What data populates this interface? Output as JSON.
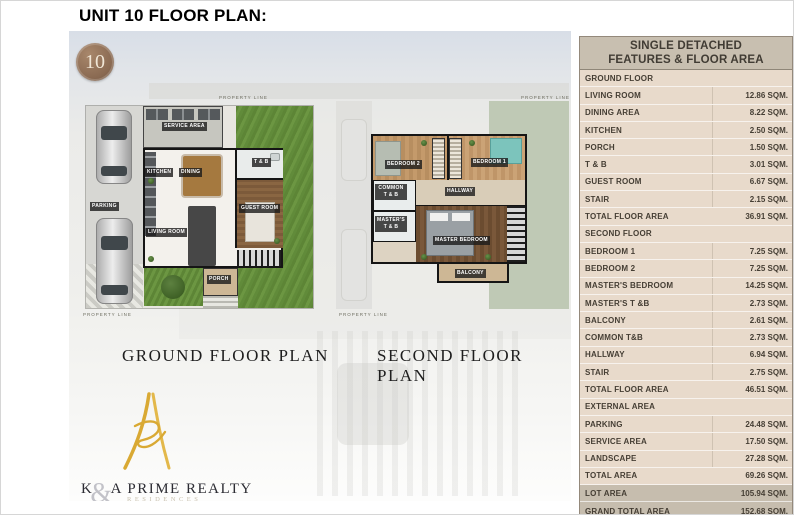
{
  "page": {
    "title": "UNIT 10 FLOOR PLAN:"
  },
  "badge": {
    "number": "10"
  },
  "plans": {
    "property_line": "PROPERTY LINE",
    "ground": {
      "caption": "GROUND FLOOR PLAN",
      "rooms": {
        "service_area": "SERVICE AREA",
        "kitchen": "KITCHEN",
        "dining": "DINING",
        "tb": "T & B",
        "guest_room": "GUEST ROOM",
        "living_room": "LIVING ROOM",
        "parking": "PARKING",
        "porch": "PORCH"
      }
    },
    "second": {
      "caption": "SECOND FLOOR PLAN",
      "rooms": {
        "bedroom2": "BEDROOM 2",
        "bedroom1": "BEDROOM 1",
        "common_tb": "COMMON T & B",
        "hallway": "HALLWAY",
        "masters_tb": "MASTER'S T & B",
        "master_bedroom": "MASTER BEDROOM",
        "balcony": "BALCONY"
      }
    }
  },
  "logo": {
    "k": "K",
    "amp": "&",
    "rest": "A PRIME REALTY",
    "sub": "RESIDENCES"
  },
  "table": {
    "title_line1": "SINGLE DETACHED",
    "title_line2": "FEATURES & FLOOR AREA",
    "sections": [
      {
        "header": "GROUND FLOOR",
        "rows": [
          {
            "label": "LIVING ROOM",
            "value": "12.86 SQM."
          },
          {
            "label": "DINING AREA",
            "value": "8.22 SQM."
          },
          {
            "label": "KITCHEN",
            "value": "2.50 SQM."
          },
          {
            "label": "PORCH",
            "value": "1.50 SQM."
          },
          {
            "label": "T & B",
            "value": "3.01 SQM."
          },
          {
            "label": "GUEST ROOM",
            "value": "6.67 SQM."
          },
          {
            "label": "STAIR",
            "value": "2.15 SQM."
          }
        ],
        "total": {
          "label": "TOTAL FLOOR AREA",
          "value": "36.91 SQM."
        }
      },
      {
        "header": "SECOND FLOOR",
        "rows": [
          {
            "label": "BEDROOM 1",
            "value": "7.25 SQM."
          },
          {
            "label": "BEDROOM 2",
            "value": "7.25 SQM."
          },
          {
            "label": "MASTER'S BEDROOM",
            "value": "14.25 SQM."
          },
          {
            "label": "MASTER'S T &B",
            "value": "2.73 SQM."
          },
          {
            "label": "BALCONY",
            "value": "2.61 SQM."
          },
          {
            "label": "COMMON T&B",
            "value": "2.73 SQM."
          },
          {
            "label": "HALLWAY",
            "value": "6.94 SQM."
          },
          {
            "label": "STAIR",
            "value": "2.75 SQM."
          }
        ],
        "total": {
          "label": "TOTAL FLOOR AREA",
          "value": "46.51 SQM."
        }
      },
      {
        "header": "EXTERNAL AREA",
        "rows": [
          {
            "label": "PARKING",
            "value": "24.48 SQM."
          },
          {
            "label": "SERVICE AREA",
            "value": "17.50 SQM."
          },
          {
            "label": "LANDSCAPE",
            "value": "27.28 SQM."
          }
        ],
        "total": {
          "label": "TOTAL AREA",
          "value": "69.26 SQM."
        }
      }
    ],
    "footer_rows": [
      {
        "label": "LOT AREA",
        "value": "105.94 SQM."
      },
      {
        "label": "GRAND TOTAL AREA",
        "value": "152.68 SQM."
      }
    ]
  },
  "colors": {
    "table_header_bg": "#c8bfb0",
    "table_row_bg": "#e8dacb",
    "table_footer_bg": "#c6bdae",
    "table_text": "#453e34",
    "badge_bg": "#8a6a52",
    "grass_green": "#628c3b",
    "logo_gold": "#d9a933",
    "wall_black": "#151515"
  }
}
